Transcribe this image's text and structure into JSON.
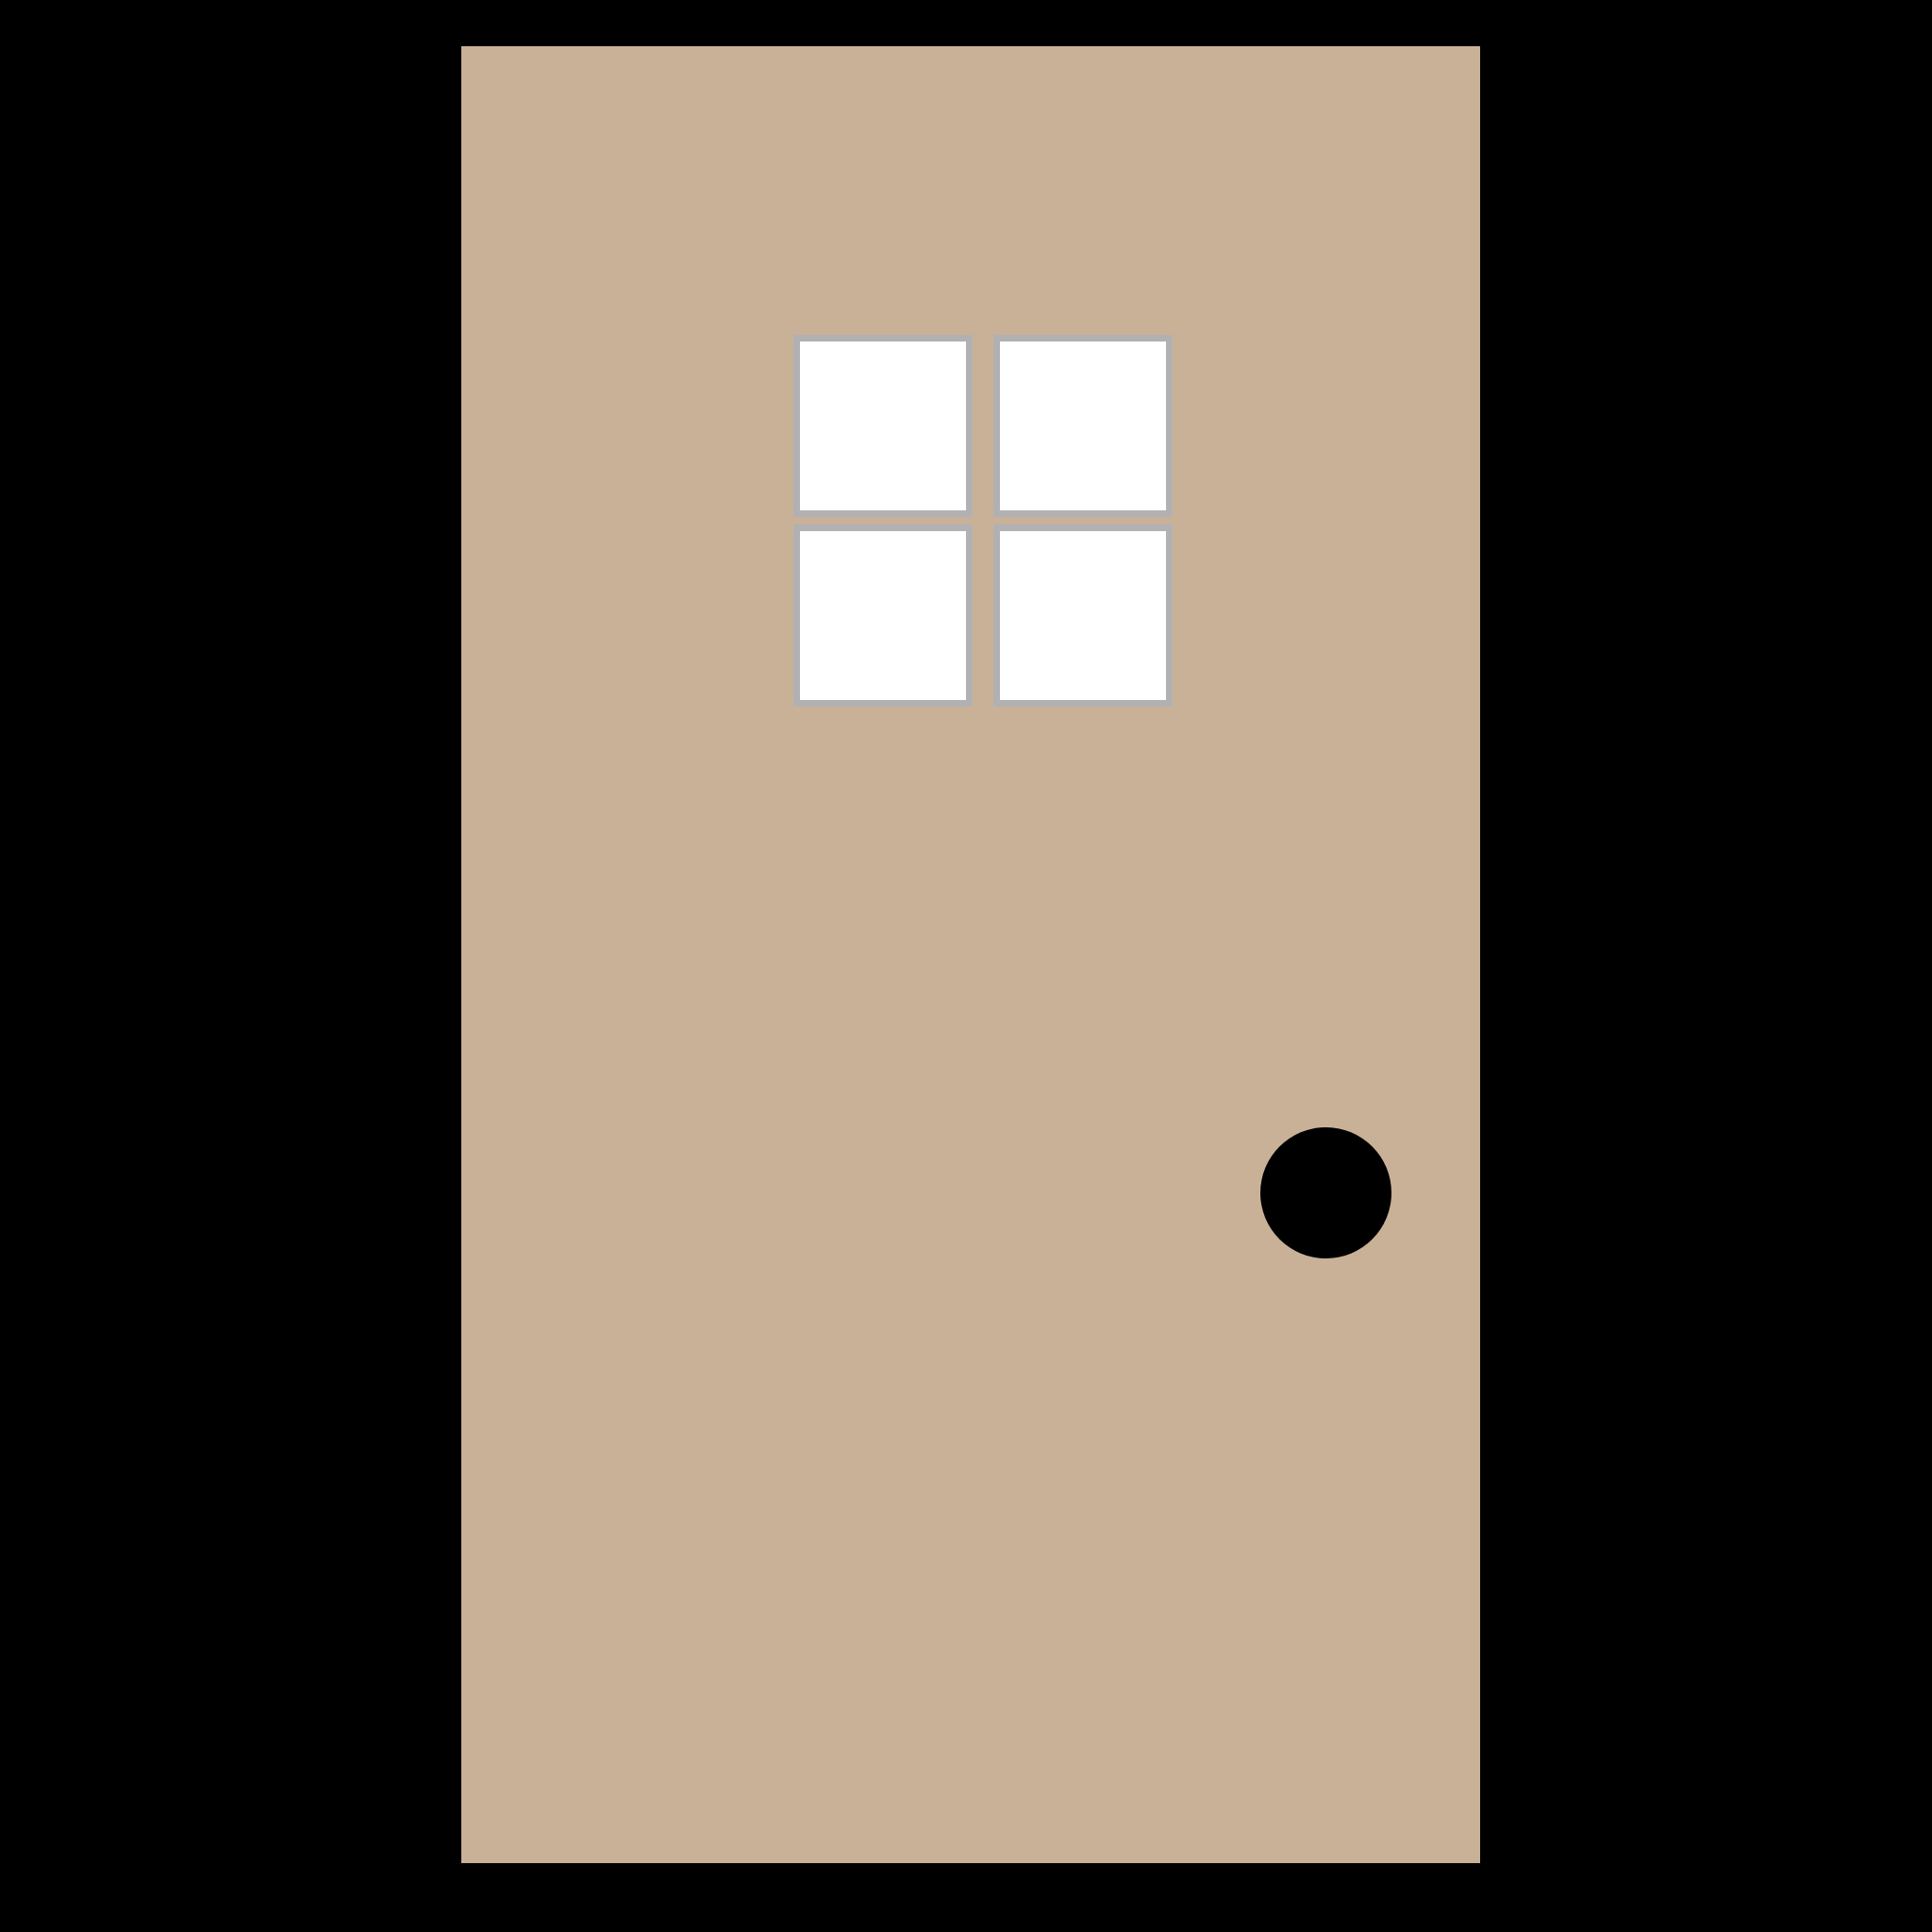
{
  "scene": {
    "description": "flat illustration of a closed door with a four-pane window and round doorknob",
    "background_color": "#000000",
    "door": {
      "color": "#C9B197"
    },
    "window": {
      "rows": 2,
      "cols": 2,
      "pane_count": 4,
      "pane_fill": "#FFFFFF",
      "mullion_color": "#B1B1B4"
    },
    "knob": {
      "color": "#000000",
      "shape": "circle"
    }
  }
}
